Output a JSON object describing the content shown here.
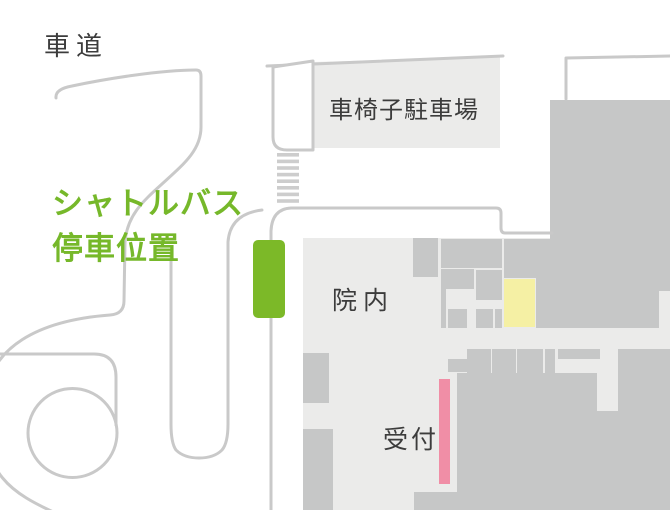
{
  "map": {
    "labels": {
      "road": "車道",
      "wheelchair_parking": "車椅子駐車場",
      "shuttle_line1": "シャトルバス",
      "shuttle_line2": "停車位置",
      "hospital_interior": "院内",
      "reception": "受付"
    },
    "colors": {
      "shuttle_green": "#7cb928",
      "shuttle_text_green": "#76b82a",
      "reception_pink": "#f08ea6",
      "highlight_yellow": "#f5f0a4",
      "road_gray": "#c9c9c9",
      "floor_light_gray": "#ebebea",
      "room_gray": "#c6c7c7",
      "label_dark": "#3c3c3c"
    }
  }
}
